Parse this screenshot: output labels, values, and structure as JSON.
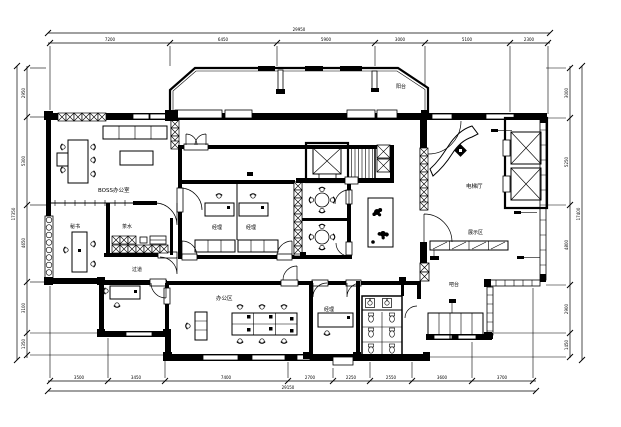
{
  "drawing": {
    "type": "office-floor-plan",
    "ink": "#000000",
    "paper": "#ffffff"
  },
  "rooms": {
    "boss_office": "BOSS办公室",
    "secretary": "秘书",
    "pantry": "茶水",
    "corridor": "过道",
    "manager_a": "经理",
    "manager_b": "经理",
    "balcony": "阳台",
    "elevator_hall": "电梯厅",
    "display_area": "展示区",
    "bar": "吧台",
    "open_office": "办公区",
    "manager_c": "经理"
  },
  "dimensions": {
    "top": {
      "segments": [
        "7200",
        "6450",
        "5900",
        "3000",
        "5100",
        "2300"
      ],
      "total": "29950"
    },
    "bottom": {
      "segments": [
        "3500",
        "3450",
        "7400",
        "2700",
        "2250",
        "2550",
        "3600",
        "3700"
      ],
      "total": "29150"
    },
    "left": {
      "segments": [
        "2950",
        "5300",
        "4650",
        "3100",
        "1350"
      ],
      "total": "17350"
    },
    "right": {
      "segments": [
        "3000",
        "5250",
        "4800",
        "2900",
        "1450"
      ],
      "total": "17400"
    }
  }
}
